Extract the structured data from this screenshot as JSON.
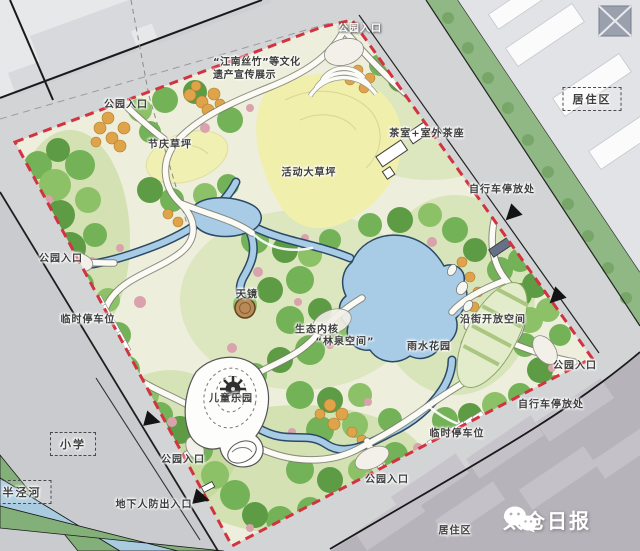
{
  "map": {
    "type": "park-master-plan",
    "labels": {
      "entrance_top": "公园入口",
      "entrance_topleft": "公园入口",
      "entrance_left": "公园入口",
      "entrance_right": "公园入口",
      "entrance_bottomleft": "公园入口",
      "entrance_bottomright": "公园入口",
      "heritage_line1": "“江南丝竹”等文化",
      "heritage_line2": "遗产宣传展示",
      "festival_lawn": "节庆草坪",
      "activity_lawn": "活动大草坪",
      "tea_house": "茶室+室外茶座",
      "residential_top": "居住区",
      "residential_bottom": "居住区",
      "bike_parking_top": "自行车停放处",
      "bike_parking_bottom": "自行车停放处",
      "temp_parking_left": "临时停车位",
      "temp_parking_bottom": "临时停车位",
      "sky_mirror": "天镜",
      "eco_core": "生态内核",
      "forest_spring": "“林泉空间”",
      "rain_garden": "雨水花园",
      "street_open_space": "沿街开放空间",
      "children_park": "儿童乐园",
      "school": "小学",
      "river": "半泾河",
      "civil_defense_exit": "地下人防出入口"
    },
    "watermark": {
      "text": "太仓日报",
      "icon": "wechat-logo"
    },
    "colors": {
      "boundary_red": "#d23340",
      "water_blue": "#a9cce6",
      "lawn_yellow": "#f1efac",
      "tree_green": "#74b258",
      "city_gray": "#d3d4d6",
      "residential_dark": "#b7b3bb",
      "accent_orange": "#dfa449",
      "accent_pink": "#d9a2ad",
      "median_green": "#8fb885"
    }
  }
}
